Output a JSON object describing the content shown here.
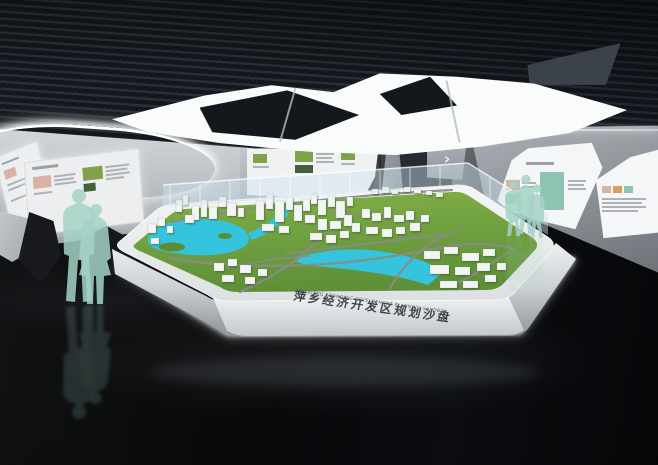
{
  "model_base": {
    "title_zh": "萍乡经济开发区规划沙盘",
    "title_en": "PINGXIANG ECONOMIC DEVELOPMENT PLANNING SANDBOX"
  },
  "signage": {
    "chevron": "›"
  },
  "colors": {
    "ceiling_dark": "#14171d",
    "ceiling_slat": "#2a2f37",
    "light_panel": "#fafcfc",
    "wall_light": "#d6dadd",
    "wall_dark": "#6a7076",
    "floor_dark": "#07080a",
    "base_light": "#eef0f1",
    "terrain": "#6fa23f",
    "water": "#35c4dd",
    "road": "#878d85",
    "building": "#f3f5f5",
    "silhouette": "#a5d2c6",
    "text_dark": "#3f444a"
  }
}
